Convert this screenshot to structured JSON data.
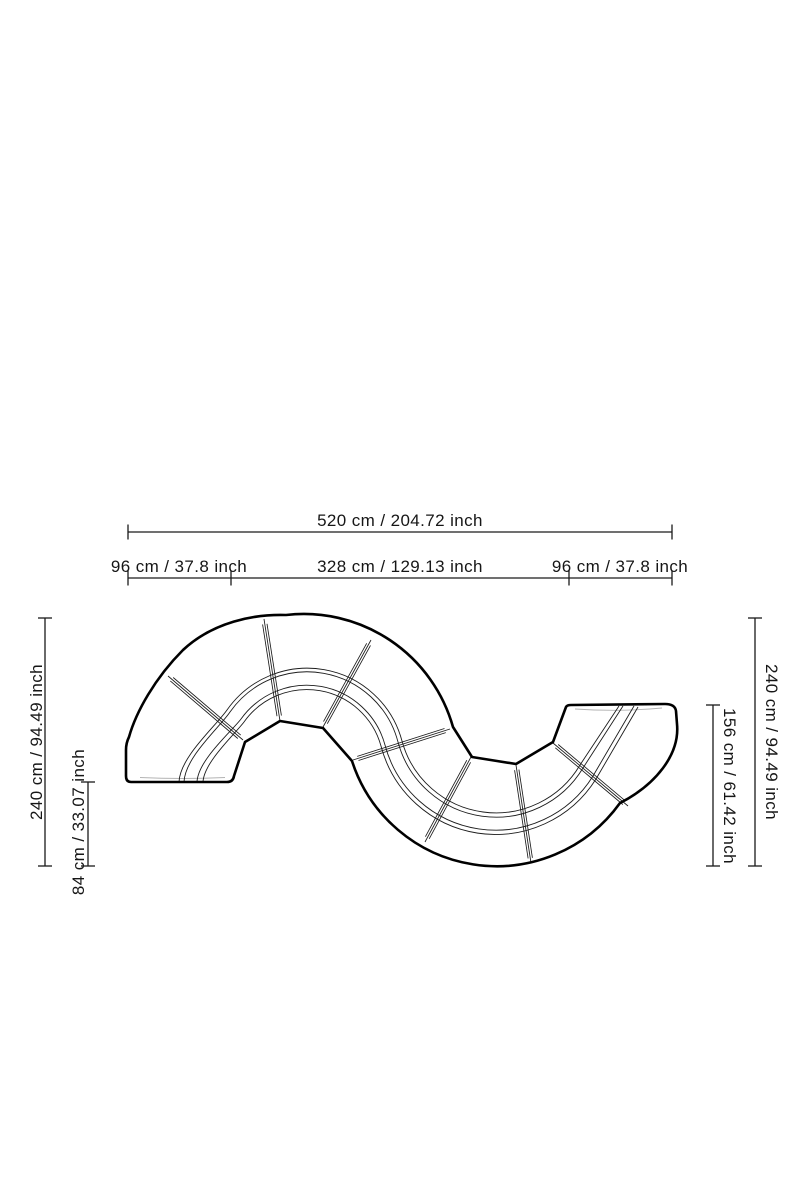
{
  "page": {
    "background": "#ffffff",
    "line_color": "#000000",
    "text_color": "#161616"
  },
  "diagram": {
    "type": "sofa-dimension-drawing-top-view",
    "labels": {
      "total_width": "520 cm / 204.72 inch",
      "left_section_width": "96 cm / 37.8 inch",
      "middle_section_width": "328 cm / 129.13 inch",
      "right_section_width": "96 cm / 37.8 inch",
      "left_overall_depth": "240 cm / 94.49 inch",
      "left_end_depth": "84 cm / 33.07 inch",
      "right_overall_depth": "240 cm / 94.49 inch",
      "right_end_depth": "156 cm / 61.42 inch"
    }
  }
}
